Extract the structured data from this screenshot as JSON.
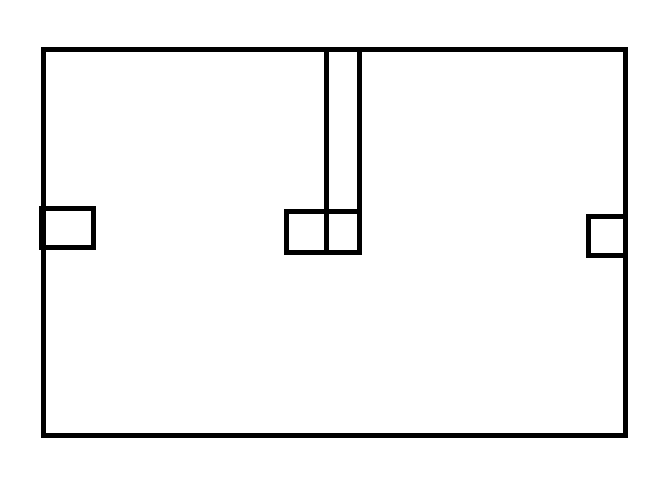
{
  "diagram": {
    "description": "floor-plan-style line drawing",
    "canvas": {
      "width": 667,
      "height": 480
    },
    "background_color": "#ffffff",
    "stroke_color": "#000000",
    "stroke_width": 5,
    "shapes": [
      {
        "name": "outer-wall-rectangle",
        "type": "rect",
        "x": 43.5,
        "y": 49.5,
        "width": 582,
        "height": 386
      },
      {
        "name": "left-wall-box",
        "type": "rect",
        "x": 41.5,
        "y": 208.5,
        "width": 52,
        "height": 39
      },
      {
        "name": "center-box",
        "type": "rect",
        "x": 286.5,
        "y": 211.5,
        "width": 73,
        "height": 41
      },
      {
        "name": "center-channel-left-line",
        "type": "line",
        "x1": 326.5,
        "y1": 49.5,
        "x2": 326.5,
        "y2": 252.5
      },
      {
        "name": "center-channel-right-line",
        "type": "line",
        "x1": 359.5,
        "y1": 49.5,
        "x2": 359.5,
        "y2": 252.5
      },
      {
        "name": "right-wall-box",
        "type": "rect",
        "x": 588.5,
        "y": 216.5,
        "width": 37,
        "height": 39
      }
    ]
  }
}
